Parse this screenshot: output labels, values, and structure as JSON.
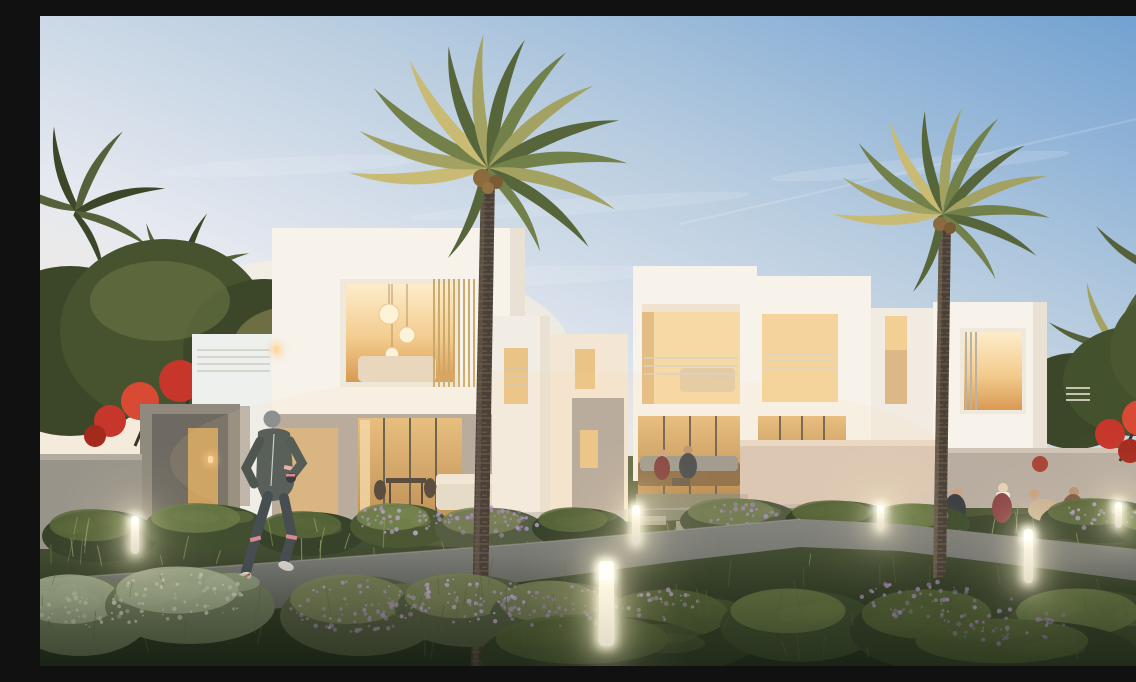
{
  "scene": {
    "description": "Dusk architectural rendering of a row of modern white two-storey townhouses with warmly lit windows, fronted by a wild landscaped garden of purple flowering shrubs, a curved walking path with glowing bollard lights, two tall date palms, red flowering trees, a jogger running on the path, two residents seated on a patio sofa and four people relaxing on the lawn.",
    "time_of_day": "dusk",
    "style": "photorealistic CGI exterior render"
  },
  "palette": {
    "sky_top": "#6f9fd0",
    "sky_mid": "#b9cde0",
    "sky_pale": "#e6e9f0",
    "horizon": "#f4ebdc",
    "wall_white": "#f7f2ea",
    "wall_shade": "#e9e1d4",
    "wall_warm": "#f3e6d4",
    "concrete": "#b3a89c",
    "concrete_dark": "#8f897e",
    "window_bright": "#fdeccb",
    "window_amber": "#eec07c",
    "window_deep": "#d89a52",
    "slat_wood": "#c9a869",
    "railing": "#d9d2c6",
    "trunk_dark": "#4a4038",
    "trunk_light": "#6d5f50",
    "frond_dark": "#57653a",
    "frond_mid": "#72804a",
    "frond_light": "#a3a263",
    "frond_sun": "#c9bb74",
    "leaf_dark": "#3c4729",
    "leaf_mid": "#55613a",
    "flower_red": "#c7362a",
    "flower_purple": "#ae93c4",
    "flower_pale": "#ccd2ba",
    "path": "#84847e",
    "path_dark": "#5e615c",
    "grass_top": "#5a6440",
    "grass_deep": "#242e1d",
    "wall_pink": "#d9c6b6",
    "bollard_glow": "#fff4cf"
  },
  "inventory": {
    "townhouse_units": 7,
    "foreground_palms": 2,
    "background_palms": 4,
    "red_flowering_trees": 2,
    "bollard_lights": 6,
    "people": {
      "jogger": 1,
      "patio_seated": 2,
      "lawn_group": 4
    }
  },
  "lights": {
    "bollards": [
      {
        "x": 95,
        "y": 500,
        "h": 38,
        "w": 8
      },
      {
        "x": 566,
        "y": 545,
        "h": 85,
        "w": 15
      },
      {
        "x": 596,
        "y": 489,
        "h": 40,
        "w": 8
      },
      {
        "x": 840,
        "y": 489,
        "h": 26,
        "w": 7
      },
      {
        "x": 988,
        "y": 513,
        "h": 54,
        "w": 9
      },
      {
        "x": 1078,
        "y": 486,
        "h": 26,
        "w": 7
      }
    ],
    "sconces": [
      {
        "x": 168,
        "y": 440
      },
      {
        "x": 234,
        "y": 330
      }
    ]
  },
  "garden": {
    "bush_types": {
      "g1": {
        "base": "#37422a",
        "top": "#59673a"
      },
      "g2": {
        "base": "#414f30",
        "top": "#6b7a46"
      },
      "g3": {
        "base": "#4c5833",
        "top": "#778550"
      },
      "sage": {
        "base": "#6f7a5c",
        "top": "#aab393"
      },
      "plume": {
        "base": "#555d43",
        "top": "#7b8258"
      }
    },
    "bushes_back": [
      [
        60,
        520,
        58,
        26,
        "g1"
      ],
      [
        165,
        512,
        62,
        24,
        "g2"
      ],
      [
        270,
        518,
        55,
        22,
        "g1"
      ],
      [
        360,
        510,
        50,
        22,
        "g3"
      ],
      [
        450,
        514,
        55,
        22,
        "plume"
      ],
      [
        540,
        512,
        48,
        20,
        "g1"
      ],
      [
        700,
        505,
        60,
        22,
        "plume"
      ],
      [
        800,
        505,
        55,
        20,
        "g1"
      ],
      [
        880,
        508,
        50,
        20,
        "g2"
      ],
      [
        1060,
        505,
        60,
        22,
        "g1"
      ],
      [
        1120,
        512,
        45,
        20,
        "g2"
      ]
    ],
    "bushes_front": [
      [
        40,
        600,
        70,
        40,
        "sage"
      ],
      [
        150,
        590,
        85,
        38,
        "sage"
      ],
      [
        320,
        600,
        80,
        40,
        "plume"
      ],
      [
        430,
        595,
        75,
        36,
        "plume"
      ],
      [
        520,
        600,
        70,
        34,
        "plume"
      ],
      [
        640,
        615,
        85,
        40,
        "g1"
      ],
      [
        760,
        610,
        80,
        36,
        "g2"
      ],
      [
        900,
        615,
        90,
        40,
        "g1"
      ],
      [
        1050,
        612,
        85,
        38,
        "g2"
      ],
      [
        560,
        640,
        120,
        40,
        "g1"
      ],
      [
        980,
        640,
        120,
        36,
        "g1"
      ]
    ],
    "flower_clusters": [
      {
        "cx": 360,
        "cy": 503,
        "rx": 45,
        "ry": 15,
        "n": 40,
        "color": "#b9a0cc"
      },
      {
        "cx": 450,
        "cy": 506,
        "rx": 50,
        "ry": 15,
        "n": 40,
        "color": "#ab90c2"
      },
      {
        "cx": 700,
        "cy": 500,
        "rx": 40,
        "ry": 13,
        "n": 26,
        "color": "#a98fc0"
      },
      {
        "cx": 1060,
        "cy": 500,
        "rx": 40,
        "ry": 13,
        "n": 24,
        "color": "#b39bc7"
      },
      {
        "cx": 320,
        "cy": 590,
        "rx": 72,
        "ry": 26,
        "n": 70,
        "color": "#b59cc9"
      },
      {
        "cx": 430,
        "cy": 586,
        "rx": 65,
        "ry": 24,
        "n": 60,
        "color": "#c4add6"
      },
      {
        "cx": 520,
        "cy": 592,
        "rx": 60,
        "ry": 22,
        "n": 55,
        "color": "#ab90c2"
      },
      {
        "cx": 620,
        "cy": 588,
        "rx": 40,
        "ry": 16,
        "n": 30,
        "color": "#b9a0cc"
      },
      {
        "cx": 880,
        "cy": 585,
        "rx": 60,
        "ry": 22,
        "n": 45,
        "color": "#a98fc0"
      },
      {
        "cx": 960,
        "cy": 605,
        "rx": 70,
        "ry": 24,
        "n": 50,
        "color": "#9c84b2"
      },
      {
        "cx": 140,
        "cy": 580,
        "rx": 70,
        "ry": 24,
        "n": 50,
        "color": "#cdd3bb"
      },
      {
        "cx": 50,
        "cy": 596,
        "rx": 55,
        "ry": 20,
        "n": 40,
        "color": "#c9cfb6"
      }
    ],
    "grass": {
      "tufts_back": {
        "x0": 0,
        "x1": 1136,
        "y0": 516,
        "y1": 552,
        "n": 40,
        "color": "#9aa06a"
      },
      "blades_front": {
        "x0": 0,
        "x1": 1136,
        "y0": 565,
        "y1": 645,
        "n": 80,
        "color": "#5d6b40"
      }
    }
  }
}
